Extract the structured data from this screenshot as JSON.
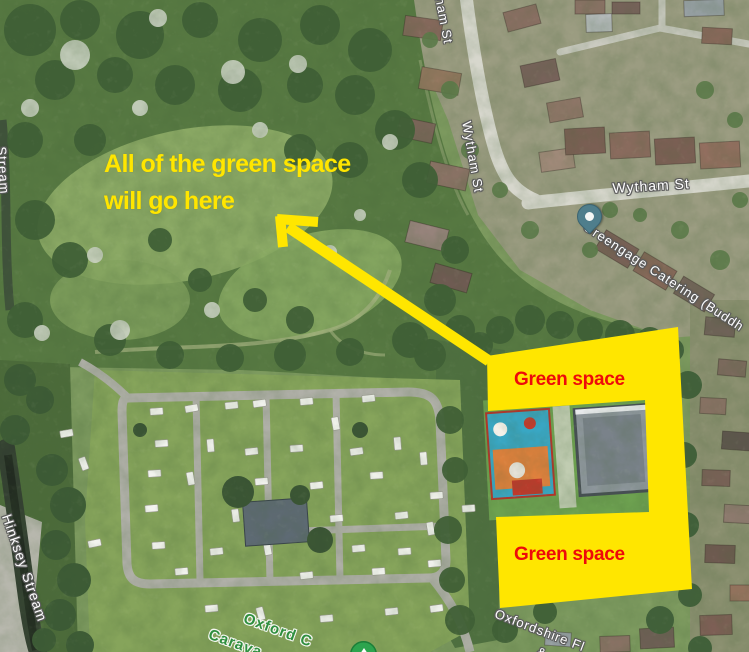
{
  "annotations": {
    "headline_line1": "All of the green space",
    "headline_line2": "will go here",
    "green_space_top": "Green space",
    "green_space_bottom": "Green space",
    "highlight_color": "#ffe600",
    "label_color": "#ee0a0a"
  },
  "map": {
    "street_labels": {
      "top_partial": "ham St",
      "wytham_vertical": "Wytham St",
      "wytham_horizontal": "Wytham St",
      "hinksey_stream": "Hinksey Stream",
      "stream_partial": "Stream"
    },
    "poi_labels": {
      "greengage": "Greengage Catering (Buddh",
      "campsite_line1": "Oxford C",
      "campsite_line2": "Carava",
      "flooring_line1": "Oxfordshire Fl",
      "flooring_line2": "&"
    },
    "markers": {
      "greengage_pin": "teal-teardrop-pin",
      "campsite_marker": "green-circle-marker"
    }
  }
}
